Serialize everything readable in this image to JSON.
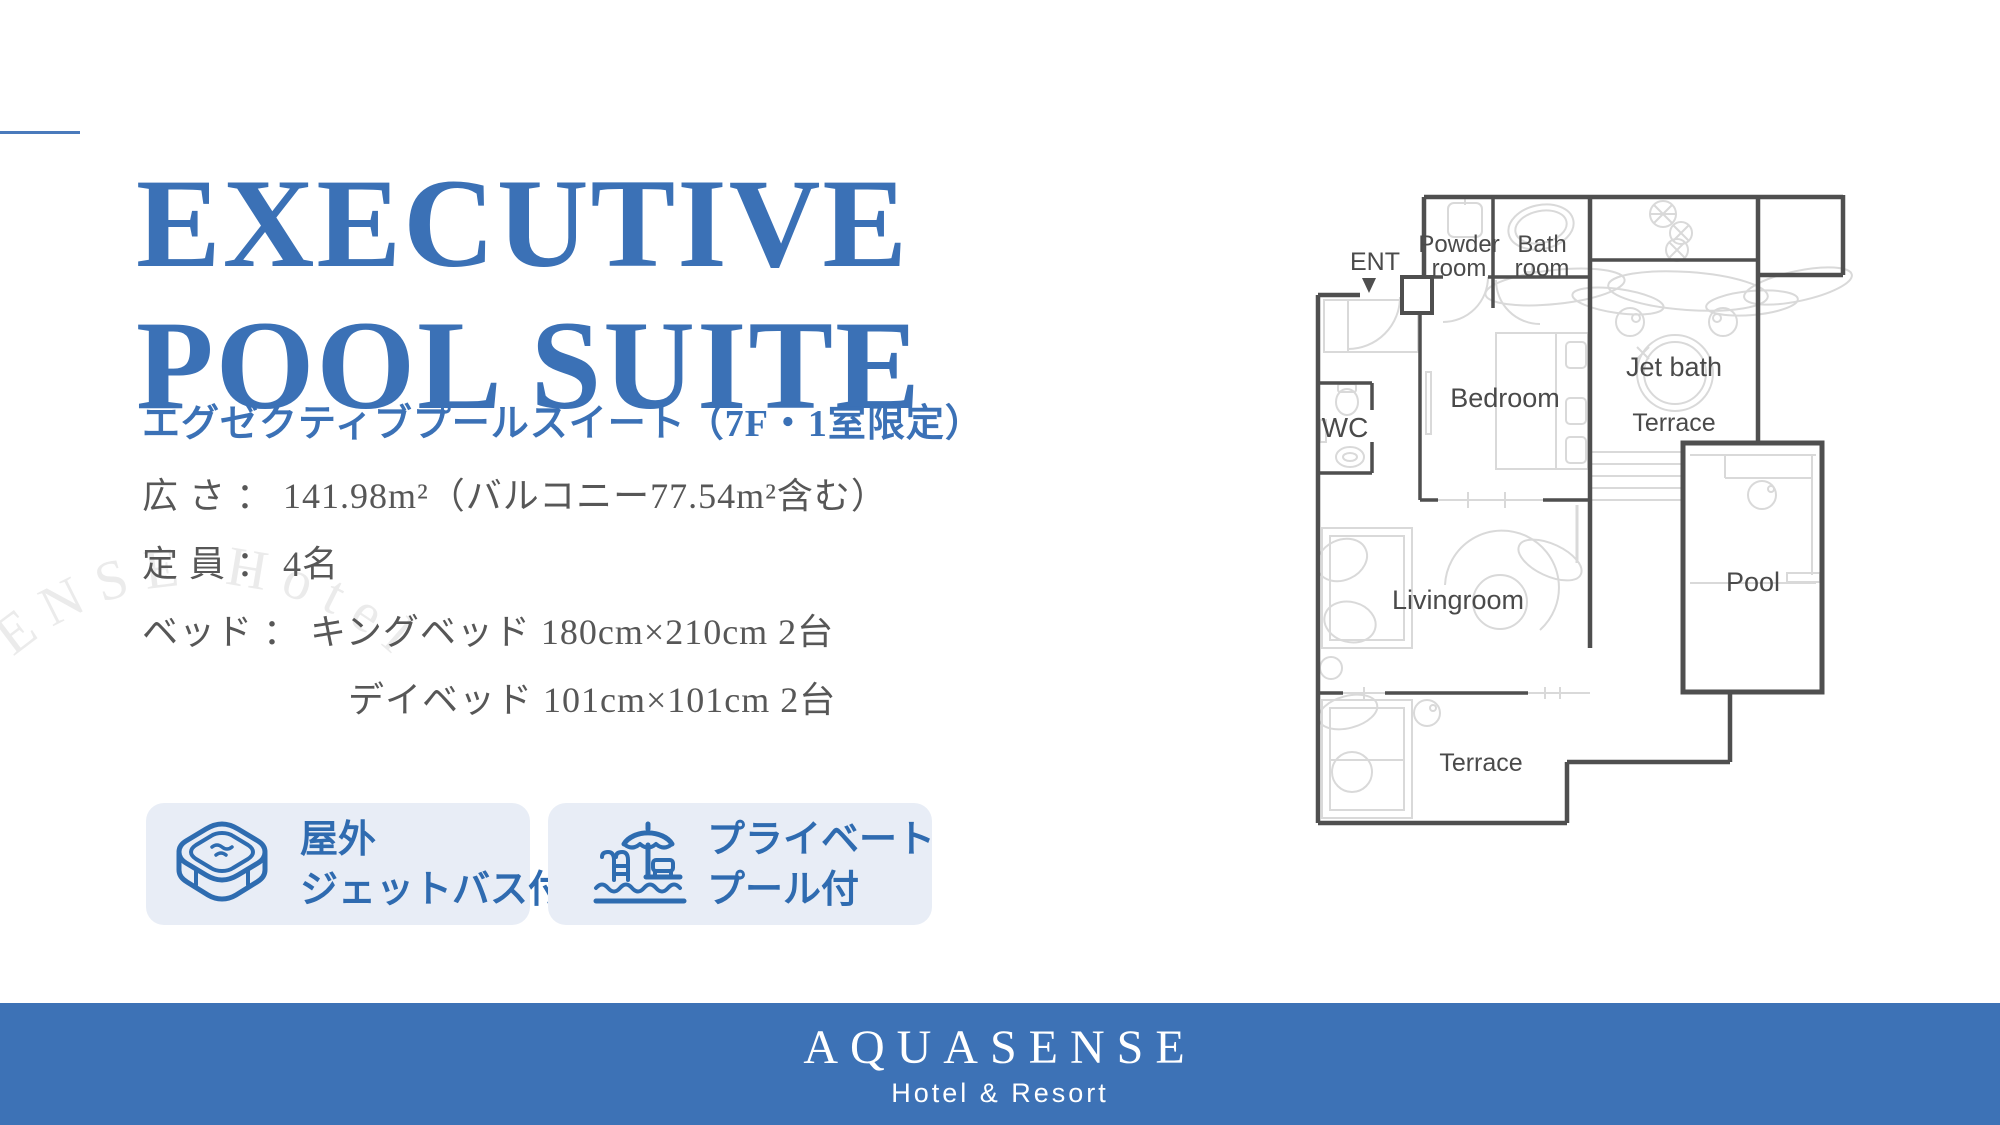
{
  "colors": {
    "brand_blue": "#3b71b6",
    "accent_blue": "#2f6bb0",
    "badge_bg": "#e8edf6",
    "footer_bg": "#3d72b6",
    "plan_wall": "#4f4f4f",
    "plan_detail": "#d9d9d9",
    "spec_text_gray": "#575757",
    "watermark_gray": "#ebebeb"
  },
  "header": {
    "title_line1": "EXECUTIVE",
    "title_line2": "POOL SUITE",
    "subtitle": "エグゼクティブプールスイート（7F・1室限定）"
  },
  "specs": {
    "rows": [
      "広 さ ： 141.98m²（バルコニー77.54m²含む）",
      "定 員 ： 4名",
      "ベッド ： キングベッド 180cm×210cm 2台",
      "デイベッド 101cm×101cm 2台"
    ]
  },
  "badges": [
    {
      "icon": "jet-bath-icon",
      "line1": "屋外",
      "line2": "ジェットバス付"
    },
    {
      "icon": "pool-icon",
      "line1": "プライベート",
      "line2": "プール付"
    }
  ],
  "watermark": {
    "text": "sort AQUASENSE Hotel"
  },
  "floorplan": {
    "ent": "ENT",
    "powder_room_line1": "Powder",
    "powder_room_line2": "room",
    "bath_room_line1": "Bath",
    "bath_room_line2": "room",
    "bedroom": "Bedroom",
    "jet_bath": "Jet bath",
    "terrace_upper": "Terrace",
    "wc": "WC",
    "livingroom": "Livingroom",
    "pool": "Pool",
    "terrace_lower": "Terrace"
  },
  "footer": {
    "brand": "AQUASENSE",
    "tagline": "Hotel & Resort"
  }
}
